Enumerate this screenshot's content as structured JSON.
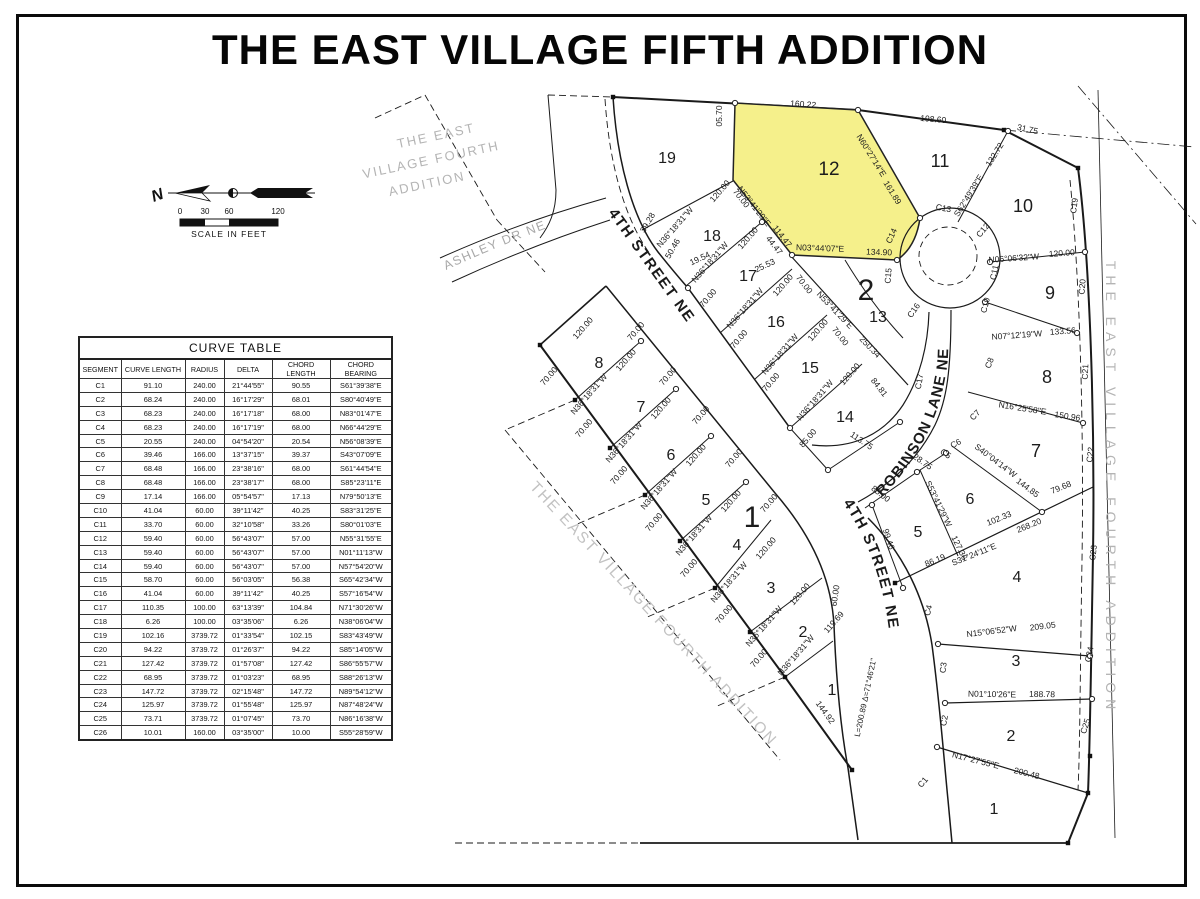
{
  "title": "THE EAST VILLAGE FIFTH ADDITION",
  "north": {
    "label": "N"
  },
  "scale_bar": {
    "ticks": [
      "0",
      "30",
      "60",
      "120"
    ],
    "caption": "SCALE IN FEET"
  },
  "curve_table": {
    "title": "CURVE TABLE",
    "headers": [
      "SEGMENT",
      "CURVE LENGTH",
      "RADIUS",
      "DELTA",
      "CHORD LENGTH",
      "CHORD BEARING"
    ],
    "rows": [
      [
        "C1",
        "91.10",
        "240.00",
        "21°44'55\"",
        "90.55",
        "S61°39'38\"E"
      ],
      [
        "C2",
        "68.24",
        "240.00",
        "16°17'29\"",
        "68.01",
        "S80°40'49\"E"
      ],
      [
        "C3",
        "68.23",
        "240.00",
        "16°17'18\"",
        "68.00",
        "N83°01'47\"E"
      ],
      [
        "C4",
        "68.23",
        "240.00",
        "16°17'19\"",
        "68.00",
        "N66°44'29\"E"
      ],
      [
        "C5",
        "20.55",
        "240.00",
        "04°54'20\"",
        "20.54",
        "N56°08'39\"E"
      ],
      [
        "C6",
        "39.46",
        "166.00",
        "13°37'15\"",
        "39.37",
        "S43°07'09\"E"
      ],
      [
        "C7",
        "68.48",
        "166.00",
        "23°38'16\"",
        "68.00",
        "S61°44'54\"E"
      ],
      [
        "C8",
        "68.48",
        "166.00",
        "23°38'17\"",
        "68.00",
        "S85°23'11\"E"
      ],
      [
        "C9",
        "17.14",
        "166.00",
        "05°54'57\"",
        "17.13",
        "N79°50'13\"E"
      ],
      [
        "C10",
        "41.04",
        "60.00",
        "39°11'42\"",
        "40.25",
        "S83°31'25\"E"
      ],
      [
        "C11",
        "33.70",
        "60.00",
        "32°10'58\"",
        "33.26",
        "S80°01'03\"E"
      ],
      [
        "C12",
        "59.40",
        "60.00",
        "56°43'07\"",
        "57.00",
        "N55°31'55\"E"
      ],
      [
        "C13",
        "59.40",
        "60.00",
        "56°43'07\"",
        "57.00",
        "N01°11'13\"W"
      ],
      [
        "C14",
        "59.40",
        "60.00",
        "56°43'07\"",
        "57.00",
        "N57°54'20\"W"
      ],
      [
        "C15",
        "58.70",
        "60.00",
        "56°03'05\"",
        "56.38",
        "S65°42'34\"W"
      ],
      [
        "C16",
        "41.04",
        "60.00",
        "39°11'42\"",
        "40.25",
        "S57°16'54\"W"
      ],
      [
        "C17",
        "110.35",
        "100.00",
        "63°13'39\"",
        "104.84",
        "N71°30'26\"W"
      ],
      [
        "C18",
        "6.26",
        "100.00",
        "03°35'06\"",
        "6.26",
        "N38°06'04\"W"
      ],
      [
        "C19",
        "102.16",
        "3739.72",
        "01°33'54\"",
        "102.15",
        "S83°43'49\"W"
      ],
      [
        "C20",
        "94.22",
        "3739.72",
        "01°26'37\"",
        "94.22",
        "S85°14'05\"W"
      ],
      [
        "C21",
        "127.42",
        "3739.72",
        "01°57'08\"",
        "127.42",
        "S86°55'57\"W"
      ],
      [
        "C22",
        "68.95",
        "3739.72",
        "01°03'23\"",
        "68.95",
        "S88°26'13\"W"
      ],
      [
        "C23",
        "147.72",
        "3739.72",
        "02°15'48\"",
        "147.72",
        "N89°54'12\"W"
      ],
      [
        "C24",
        "125.97",
        "3739.72",
        "01°55'48\"",
        "125.97",
        "N87°48'24\"W"
      ],
      [
        "C25",
        "73.71",
        "3739.72",
        "01°07'45\"",
        "73.70",
        "N86°16'38\"W"
      ],
      [
        "C26",
        "10.01",
        "160.00",
        "03°35'00\"",
        "10.00",
        "S55°28'59\"W"
      ]
    ]
  },
  "map": {
    "highlight_color": "#f5f08b",
    "street_labels": [
      {
        "text": "4TH STREET NE",
        "path": "sp1",
        "size": 15,
        "ls": 1.5,
        "bold": true,
        "color": "#1a1a1a"
      },
      {
        "text": "4TH STREET NE",
        "path": "sp2",
        "size": 15,
        "ls": 1.5,
        "bold": true,
        "color": "#1a1a1a"
      },
      {
        "text": "ROBINSON  LANE  NE",
        "path": "sp3",
        "size": 15,
        "ls": 1,
        "bold": true,
        "color": "#1a1a1a"
      },
      {
        "text": "ASHLEY DR NE",
        "path": "sp4",
        "size": 12.5,
        "ls": 1.5,
        "bold": false,
        "color": "#a8a8a8"
      }
    ],
    "labels": [
      [
        "05.70",
        722,
        116,
        -90,
        8.5
      ],
      [
        "160.22",
        803,
        107,
        4,
        8.5
      ],
      [
        "198.60",
        933,
        122,
        5,
        8.5
      ],
      [
        "31.75",
        1027,
        132,
        12,
        8.5
      ],
      [
        "N60°27'14\"E",
        869,
        157,
        58,
        8.5
      ],
      [
        "161.89",
        890,
        194,
        58,
        8.5
      ],
      [
        "S62°49'39\"E",
        971,
        197,
        -58,
        8.5
      ],
      [
        "132.72",
        997,
        156,
        -58,
        8.5
      ],
      [
        "N03°44'07\"E",
        820,
        251,
        2,
        8.5
      ],
      [
        "134.90",
        879,
        255,
        2,
        8.5
      ],
      [
        "N53°41'29\"E",
        752,
        208,
        52,
        8.5
      ],
      [
        "114.47",
        780,
        238,
        52,
        8.5
      ],
      [
        "70.00",
        739,
        200,
        52,
        8.5
      ],
      [
        "44.47",
        772,
        247,
        52,
        8.5
      ],
      [
        "N36°18'31\"W",
        677,
        229,
        -49,
        8.5
      ],
      [
        "120.00",
        722,
        193,
        -49,
        8.5
      ],
      [
        "19.54",
        701,
        261,
        -25,
        8.5
      ],
      [
        "25.53",
        766,
        268,
        -25,
        8.5
      ],
      [
        "39.28",
        650,
        224,
        -60,
        8.5
      ],
      [
        "50.46",
        675,
        250,
        -60,
        8.5
      ],
      [
        "N36°18'31\"W",
        712,
        264,
        -49,
        8.5
      ],
      [
        "120.00",
        750,
        240,
        -49,
        8.5
      ],
      [
        "N36°18'31\"W",
        747,
        310,
        -49,
        8.5
      ],
      [
        "120.00",
        785,
        287,
        -49,
        8.5
      ],
      [
        "N36°18'31\"W",
        782,
        356,
        -49,
        8.5
      ],
      [
        "120.00",
        820,
        332,
        -49,
        8.5
      ],
      [
        "N36°18'31\"W",
        817,
        402,
        -49,
        8.5
      ],
      [
        "120.00",
        852,
        376,
        -49,
        8.5
      ],
      [
        "70.00",
        710,
        300,
        -49,
        8.5
      ],
      [
        "70.00",
        741,
        341,
        -49,
        8.5
      ],
      [
        "70.00",
        773,
        384,
        -49,
        8.5
      ],
      [
        "70.00",
        802,
        286,
        52,
        8.5
      ],
      [
        "70.00",
        838,
        338,
        52,
        8.5
      ],
      [
        "N53°41'29\"E",
        833,
        312,
        46,
        8.5
      ],
      [
        "250.34",
        868,
        349,
        46,
        8.5
      ],
      [
        "84.81",
        877,
        389,
        52,
        8.5
      ],
      [
        "85.00",
        810,
        440,
        -49,
        8.5
      ],
      [
        "113.75",
        860,
        443,
        34,
        8.5
      ],
      [
        "N36°18'31\"W",
        591,
        396,
        -49,
        8.5
      ],
      [
        "120.00",
        628,
        362,
        -49,
        8.5
      ],
      [
        "N36°18'31\"W",
        626,
        444,
        -49,
        8.5
      ],
      [
        "120.00",
        663,
        410,
        -49,
        8.5
      ],
      [
        "N36°18'31\"W",
        661,
        491,
        -49,
        8.5
      ],
      [
        "120.00",
        698,
        457,
        -49,
        8.5
      ],
      [
        "N36°18'31\"W",
        696,
        537,
        -49,
        8.5
      ],
      [
        "120.00",
        733,
        503,
        -49,
        8.5
      ],
      [
        "N36°18'31\"W",
        731,
        584,
        -49,
        8.5
      ],
      [
        "120.00",
        768,
        550,
        -49,
        8.5
      ],
      [
        "N36°18'31\"W",
        766,
        628,
        -49,
        8.5
      ],
      [
        "120.00",
        802,
        596,
        -49,
        8.5
      ],
      [
        "N36°18'31\"W",
        798,
        657,
        -49,
        8.5
      ],
      [
        "119.69",
        836,
        624,
        -49,
        8.5
      ],
      [
        "120.00",
        585,
        330,
        -49,
        8.5
      ],
      [
        "70.00",
        551,
        378,
        -49,
        8.5
      ],
      [
        "70.00",
        586,
        430,
        -49,
        8.5
      ],
      [
        "70.00",
        621,
        477,
        -49,
        8.5
      ],
      [
        "70.00",
        656,
        524,
        -49,
        8.5
      ],
      [
        "70.00",
        691,
        570,
        -49,
        8.5
      ],
      [
        "70.00",
        726,
        616,
        -49,
        8.5
      ],
      [
        "70.00",
        761,
        660,
        -49,
        8.5
      ],
      [
        "70.00",
        638,
        333,
        -49,
        8.5
      ],
      [
        "70.00",
        670,
        378,
        -49,
        8.5
      ],
      [
        "70.00",
        703,
        417,
        -49,
        8.5
      ],
      [
        "70.00",
        736,
        460,
        -49,
        8.5
      ],
      [
        "70.00",
        771,
        505,
        -49,
        8.5
      ],
      [
        "60.00",
        838,
        596,
        -82,
        8.5
      ],
      [
        "144.92",
        823,
        714,
        54,
        8.5
      ],
      [
        "L=200.89  Δ=71°46'21\"",
        868,
        698,
        -78,
        8
      ],
      [
        "28.75",
        921,
        464,
        35,
        8.5
      ],
      [
        "C5",
        944,
        456,
        35,
        8.5
      ],
      [
        "S53°41'29\"W",
        936,
        505,
        64,
        8.5
      ],
      [
        "127.36",
        957,
        549,
        64,
        8.5
      ],
      [
        "85.00",
        879,
        496,
        38,
        8.5
      ],
      [
        "99.46",
        886,
        540,
        72,
        8.5
      ],
      [
        "86.19",
        936,
        563,
        -22,
        8.5
      ],
      [
        "102.33",
        1000,
        521,
        -22,
        8.5
      ],
      [
        "S31°24'11\"E",
        975,
        557,
        -22,
        8.5
      ],
      [
        "268.20",
        1030,
        528,
        -22,
        8.5
      ],
      [
        "79.68",
        1062,
        490,
        -22,
        8.5
      ],
      [
        "S40°04'14\"W",
        994,
        463,
        37,
        8.5
      ],
      [
        "144.85",
        1026,
        490,
        37,
        8.5
      ],
      [
        "N16°25'58\"E",
        1022,
        411,
        9,
        8.5
      ],
      [
        "150.96",
        1067,
        419,
        9,
        8.5
      ],
      [
        "N07°12'19\"W",
        1017,
        338,
        -4,
        8.5
      ],
      [
        "133.56",
        1063,
        334,
        -4,
        8.5
      ],
      [
        "N06°06'32\"W",
        1014,
        261,
        -4,
        8.5
      ],
      [
        "120.00",
        1062,
        256,
        -4,
        8.5
      ],
      [
        "N15°06'52\"W",
        992,
        634,
        -7,
        8.5
      ],
      [
        "209.05",
        1043,
        629,
        -7,
        8.5
      ],
      [
        "N01°10'26\"E",
        992,
        697,
        1,
        8.5
      ],
      [
        "188.78",
        1042,
        697,
        1,
        8.5
      ],
      [
        "N17°27'55\"E",
        975,
        763,
        14,
        8.5
      ],
      [
        "200.48",
        1026,
        776,
        14,
        8.5
      ],
      [
        "C19",
        1077,
        206,
        -83,
        8.5
      ],
      [
        "C20",
        1085,
        287,
        -85,
        8.5
      ],
      [
        "C21",
        1088,
        372,
        -87,
        8.5
      ],
      [
        "C22",
        1093,
        455,
        -84,
        8.5
      ],
      [
        "C23",
        1096,
        553,
        -84,
        8.5
      ],
      [
        "C24",
        1092,
        655,
        -78,
        8.5
      ],
      [
        "C25",
        1088,
        727,
        -72,
        8.5
      ],
      [
        "C4",
        931,
        611,
        -75,
        8.5
      ],
      [
        "C3",
        946,
        668,
        -83,
        8.5
      ],
      [
        "C2",
        947,
        721,
        -80,
        8.5
      ],
      [
        "C1",
        925,
        784,
        -50,
        8.5
      ],
      [
        "C13",
        943,
        211,
        10,
        8.5
      ],
      [
        "C12",
        985,
        232,
        -50,
        8.5
      ],
      [
        "C11",
        997,
        273,
        -78,
        8.5
      ],
      [
        "C10",
        988,
        306,
        -75,
        8.5
      ],
      [
        "C8",
        992,
        364,
        -68,
        8.5
      ],
      [
        "C7",
        977,
        417,
        -45,
        8.5
      ],
      [
        "C6",
        957,
        446,
        -28,
        8.5
      ],
      [
        "C14",
        894,
        237,
        -65,
        8.5
      ],
      [
        "C15",
        891,
        276,
        -85,
        8.5
      ],
      [
        "C16",
        916,
        312,
        -55,
        8.5
      ],
      [
        "C17",
        922,
        382,
        -80,
        8.5
      ],
      [
        "19",
        667,
        163,
        0,
        16
      ],
      [
        "18",
        712,
        241,
        0,
        16
      ],
      [
        "17",
        748,
        281,
        0,
        16
      ],
      [
        "16",
        776,
        327,
        0,
        16
      ],
      [
        "15",
        810,
        373,
        0,
        16
      ],
      [
        "14",
        845,
        422,
        0,
        16
      ],
      [
        "13",
        878,
        322,
        0,
        16
      ],
      [
        "12",
        829,
        175,
        0,
        19
      ],
      [
        "11",
        940,
        167,
        0,
        18
      ],
      [
        "10",
        1023,
        212,
        0,
        18
      ],
      [
        "9",
        1050,
        299,
        0,
        18
      ],
      [
        "8",
        1047,
        383,
        0,
        18
      ],
      [
        "7",
        1036,
        457,
        0,
        18
      ],
      [
        "6",
        970,
        504,
        0,
        16
      ],
      [
        "5",
        918,
        537,
        0,
        16
      ],
      [
        "4",
        1017,
        582,
        0,
        16
      ],
      [
        "3",
        1016,
        666,
        0,
        16
      ],
      [
        "2",
        1011,
        741,
        0,
        16
      ],
      [
        "1",
        994,
        814,
        0,
        16
      ],
      [
        "8",
        599,
        368,
        0,
        16
      ],
      [
        "7",
        641,
        412,
        0,
        16
      ],
      [
        "6",
        671,
        460,
        0,
        16
      ],
      [
        "5",
        706,
        505,
        0,
        16
      ],
      [
        "4",
        737,
        550,
        0,
        16
      ],
      [
        "3",
        771,
        593,
        0,
        16
      ],
      [
        "2",
        803,
        637,
        0,
        16
      ],
      [
        "1",
        832,
        695,
        0,
        16
      ],
      [
        "1",
        752,
        527,
        0,
        30
      ],
      [
        "2",
        866,
        300,
        0,
        30
      ],
      [
        "THE EAST",
        437,
        140,
        -12,
        13,
        {
          "c": "#b4b4b4",
          "ls": 2
        }
      ],
      [
        "VILLAGE FOURTH",
        432,
        164,
        -12,
        13,
        {
          "c": "#b4b4b4",
          "ls": 2
        }
      ],
      [
        "ADDITION",
        428,
        188,
        -12,
        13,
        {
          "c": "#b4b4b4",
          "ls": 2
        }
      ],
      [
        "THE EAST VILLAGE FOURTH ADDITION",
        650,
        617,
        47,
        15.5,
        {
          "c": "#c2c2c2",
          "ls": 2
        }
      ],
      [
        "THE EAST VILLAGE FOURTH ADDITION",
        1106,
        488,
        90,
        14,
        {
          "c": "#b4b4b4",
          "ls": 6
        }
      ]
    ]
  }
}
